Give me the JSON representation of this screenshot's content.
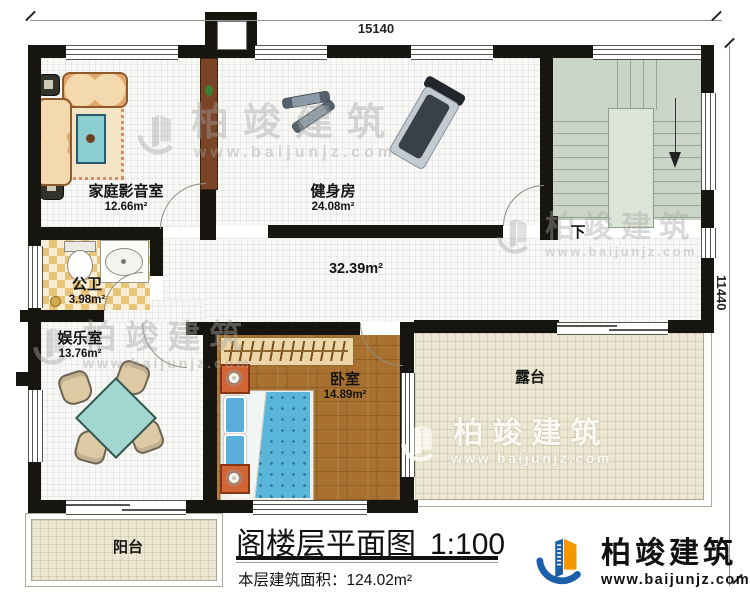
{
  "dimensions": {
    "width_label": "15140",
    "height_label": "11440"
  },
  "rooms": {
    "home_theater": {
      "name": "家庭影音室",
      "area": "12.66m²"
    },
    "gym": {
      "name": "健身房",
      "area": "24.08m²"
    },
    "bathroom": {
      "name": "公卫",
      "area": "3.98m²"
    },
    "entertainment": {
      "name": "娱乐室",
      "area": "13.76m²"
    },
    "bedroom": {
      "name": "卧室",
      "area": "14.89m²"
    },
    "corridor": {
      "area": "32.39m²"
    },
    "terrace": {
      "name": "露台"
    },
    "balcony": {
      "name": "阳台"
    },
    "stairs": {
      "direction_label": "下"
    }
  },
  "title_block": {
    "title": "阁楼层平面图",
    "scale": "1:100",
    "floor_area_label": "本层建筑面积：",
    "floor_area_value": "124.02m²"
  },
  "brand": {
    "name": "柏竣建筑",
    "website": "www.baijunjz.com"
  },
  "watermark": {
    "name": "柏竣建筑",
    "website": "www.baijunjz.com"
  },
  "colors": {
    "wall": "#17150f",
    "stair_floor": "#cbd5c7",
    "wood_floor": "#a8712f",
    "terrace_floor": "#ece7d2",
    "bed_blue": "#5ab5db",
    "brand_blue": "#1b5fa8",
    "brand_orange": "#f39800"
  }
}
